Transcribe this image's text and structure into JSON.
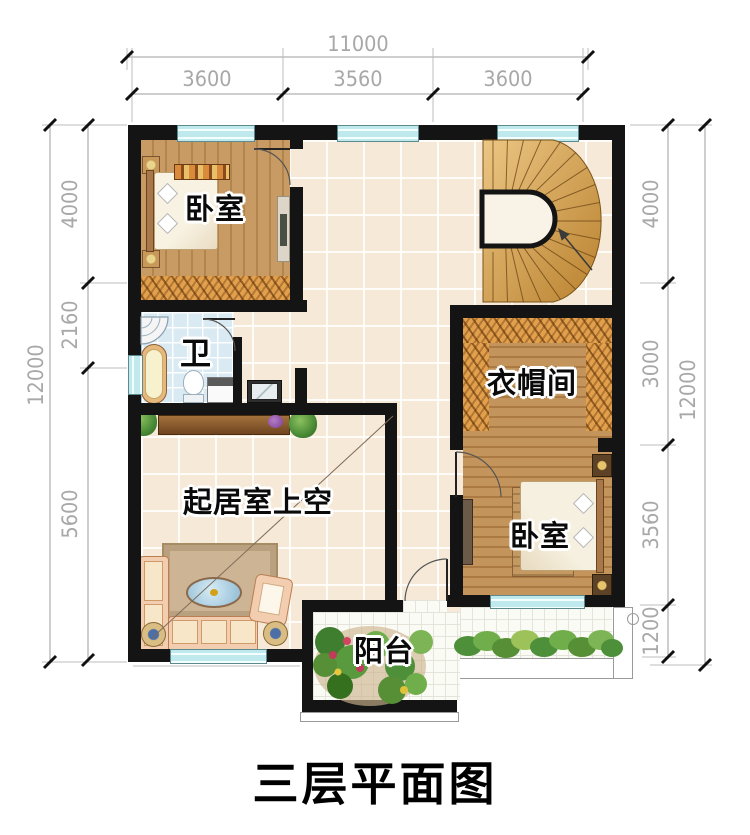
{
  "title": "三层平面图",
  "rooms": {
    "bedroom_top_left": "卧室",
    "bathroom": "卫",
    "cloakroom": "衣帽间",
    "living_void": "起居室上空",
    "bedroom_bottom_right": "卧室",
    "balcony": "阳台"
  },
  "dimensions": {
    "top": {
      "total": "11000",
      "segments": [
        "3600",
        "3560",
        "3600"
      ]
    },
    "left": {
      "total": "12000",
      "segments": [
        "4000",
        "2160",
        "5600"
      ]
    },
    "right": {
      "total": "12000",
      "segments": [
        "4000",
        "3000",
        "3560",
        "1200"
      ]
    }
  },
  "colors": {
    "wall": "#141414",
    "window_glass": "#bfe9ec",
    "floor_tile": "#f6e9d7",
    "bedroom_wood": "#c79b63",
    "wardrobe_hatch": "#e2a04c",
    "stair_wood": "#d9a953",
    "bathroom_tile": "#d9eaf2",
    "balcony_tile": "#fbfbf6",
    "dim_text": "#a8a8a8",
    "plant_green": "#4e8f3a"
  }
}
